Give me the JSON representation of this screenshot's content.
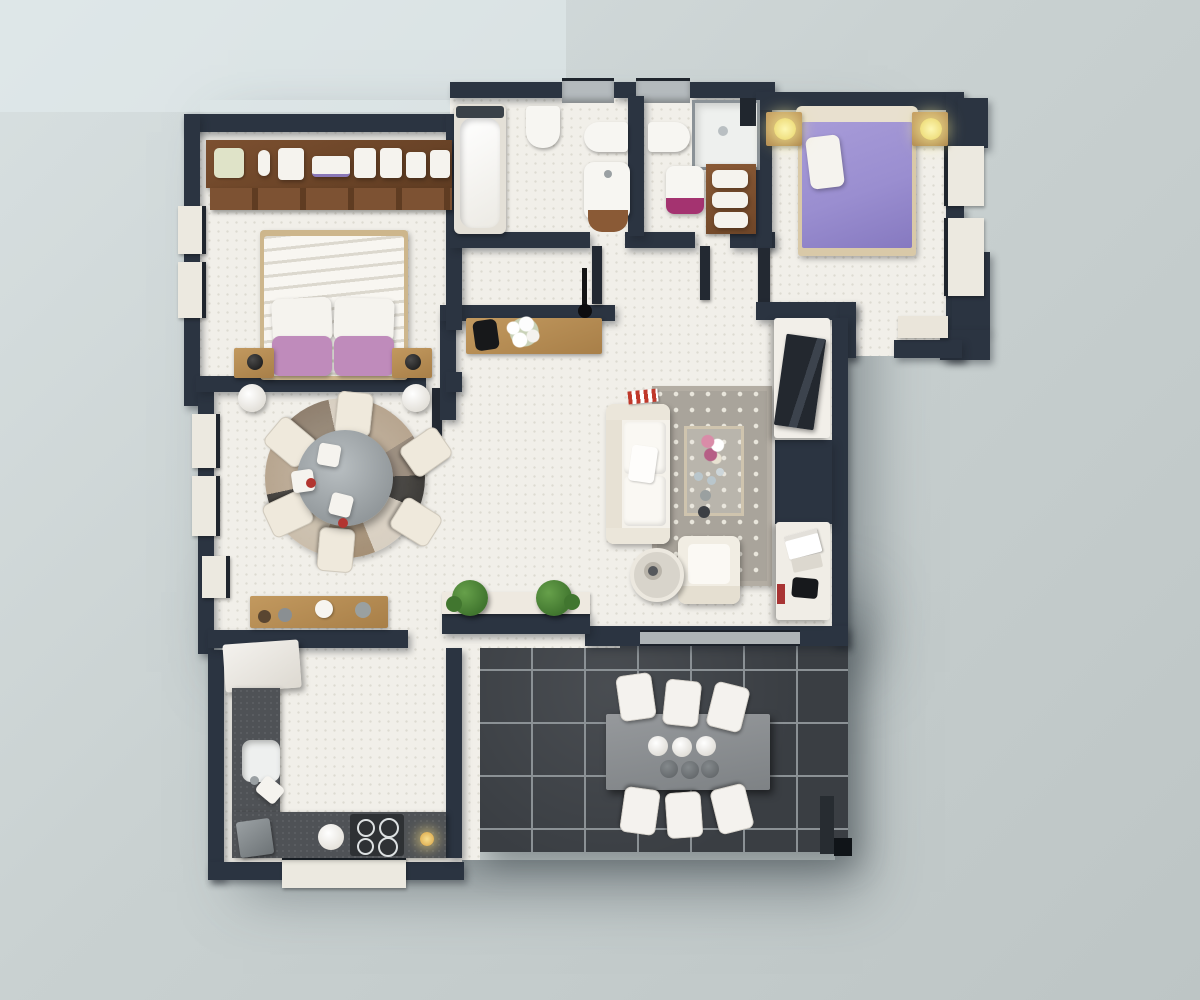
{
  "scene": {
    "type": "3d-rendered-apartment-floor-plan-top-view",
    "rooms": [
      {
        "name": "bedroom-1",
        "furniture": [
          "wardrobe-shelf-with-folded-linen",
          "drawer-row",
          "double-bed-white",
          "pink-pillows-x2",
          "nightstand-left",
          "nightstand-right",
          "black-table-lamp-x2",
          "floor-vase-x2"
        ]
      },
      {
        "name": "dining-area",
        "furniture": [
          "round-patchwork-rug",
          "round-mosaic-table",
          "dining-chair-x6",
          "white-plates",
          "wood-sideboard"
        ]
      },
      {
        "name": "kitchen",
        "furniture": [
          "refrigerator",
          "l-shaped-dark-counter",
          "sink",
          "cutting-board",
          "coffee-machine",
          "white-bowl",
          "cooktop-4-burner",
          "candle"
        ]
      },
      {
        "name": "bathroom-1",
        "furniture": [
          "bathtub",
          "bidet",
          "wall-hung-toilet",
          "vanity-sink-wood-base"
        ]
      },
      {
        "name": "bathroom-2",
        "furniture": [
          "wall-hung-toilet",
          "shower-cabin",
          "magenta-vanity-sink",
          "wood-towel-shelf"
        ]
      },
      {
        "name": "hallway-entry",
        "furniture": [
          "wood-console",
          "white-flower-vase",
          "black-bag",
          "pendant-lamp"
        ]
      },
      {
        "name": "bedroom-2",
        "furniture": [
          "double-bed-purple",
          "white-pillow",
          "nightstand-x2",
          "glowing-lamp-x2",
          "window-bench"
        ]
      },
      {
        "name": "living-room",
        "furniture": [
          "white-sofa",
          "polka-dot-rug",
          "coffee-table-with-flowers",
          "armchair",
          "round-side-table",
          "tv-sideboard",
          "tv",
          "desk-with-books",
          "red-striped-box"
        ]
      },
      {
        "name": "terrace",
        "furniture": [
          "gray-outdoor-table",
          "outdoor-chair-x6",
          "white-bowls-x3",
          "gray-vases-x3",
          "planter-x2",
          "corner-step"
        ]
      }
    ],
    "windows": [
      "bedroom-1-left-x2",
      "dining-left-x3",
      "kitchen-south",
      "bathrooms-top-x2",
      "bedroom-2-right-x2"
    ],
    "doors": [
      "bathroom-1-door",
      "bathroom-2-door",
      "bedroom-1-door",
      "bedroom-2-door",
      "terrace-sliding-door"
    ]
  },
  "colors": {
    "background_top": "#d8e0e1",
    "background": "#c9d1d1",
    "background_bottom": "#bdc5c5",
    "wall": "#2b3441",
    "wall_light": "#3c4654",
    "floor": "#f1efe9",
    "terrace_tile": "#3a3e43",
    "terrace_grout": "#8b9195",
    "wood_dark": "#6f4628",
    "wood": "#8a5a36",
    "wood_light": "#c2995f",
    "white_furniture": "#f5f3ee",
    "cream": "#efe9dc",
    "pink": "#bf8bbb",
    "purple": "#9a8ed0",
    "magenta": "#a43370",
    "lamp_glow": "#f6eb95",
    "plant": "#41762f",
    "plant_light": "#66a04a",
    "rug": "#a9a49b",
    "rug_dot": "#e9e6dc",
    "counter": "#4f5256",
    "appliance": "#8e9396",
    "table_gray": "#8f9396",
    "red": "#b23530",
    "sill_gray": "#b4babd"
  }
}
